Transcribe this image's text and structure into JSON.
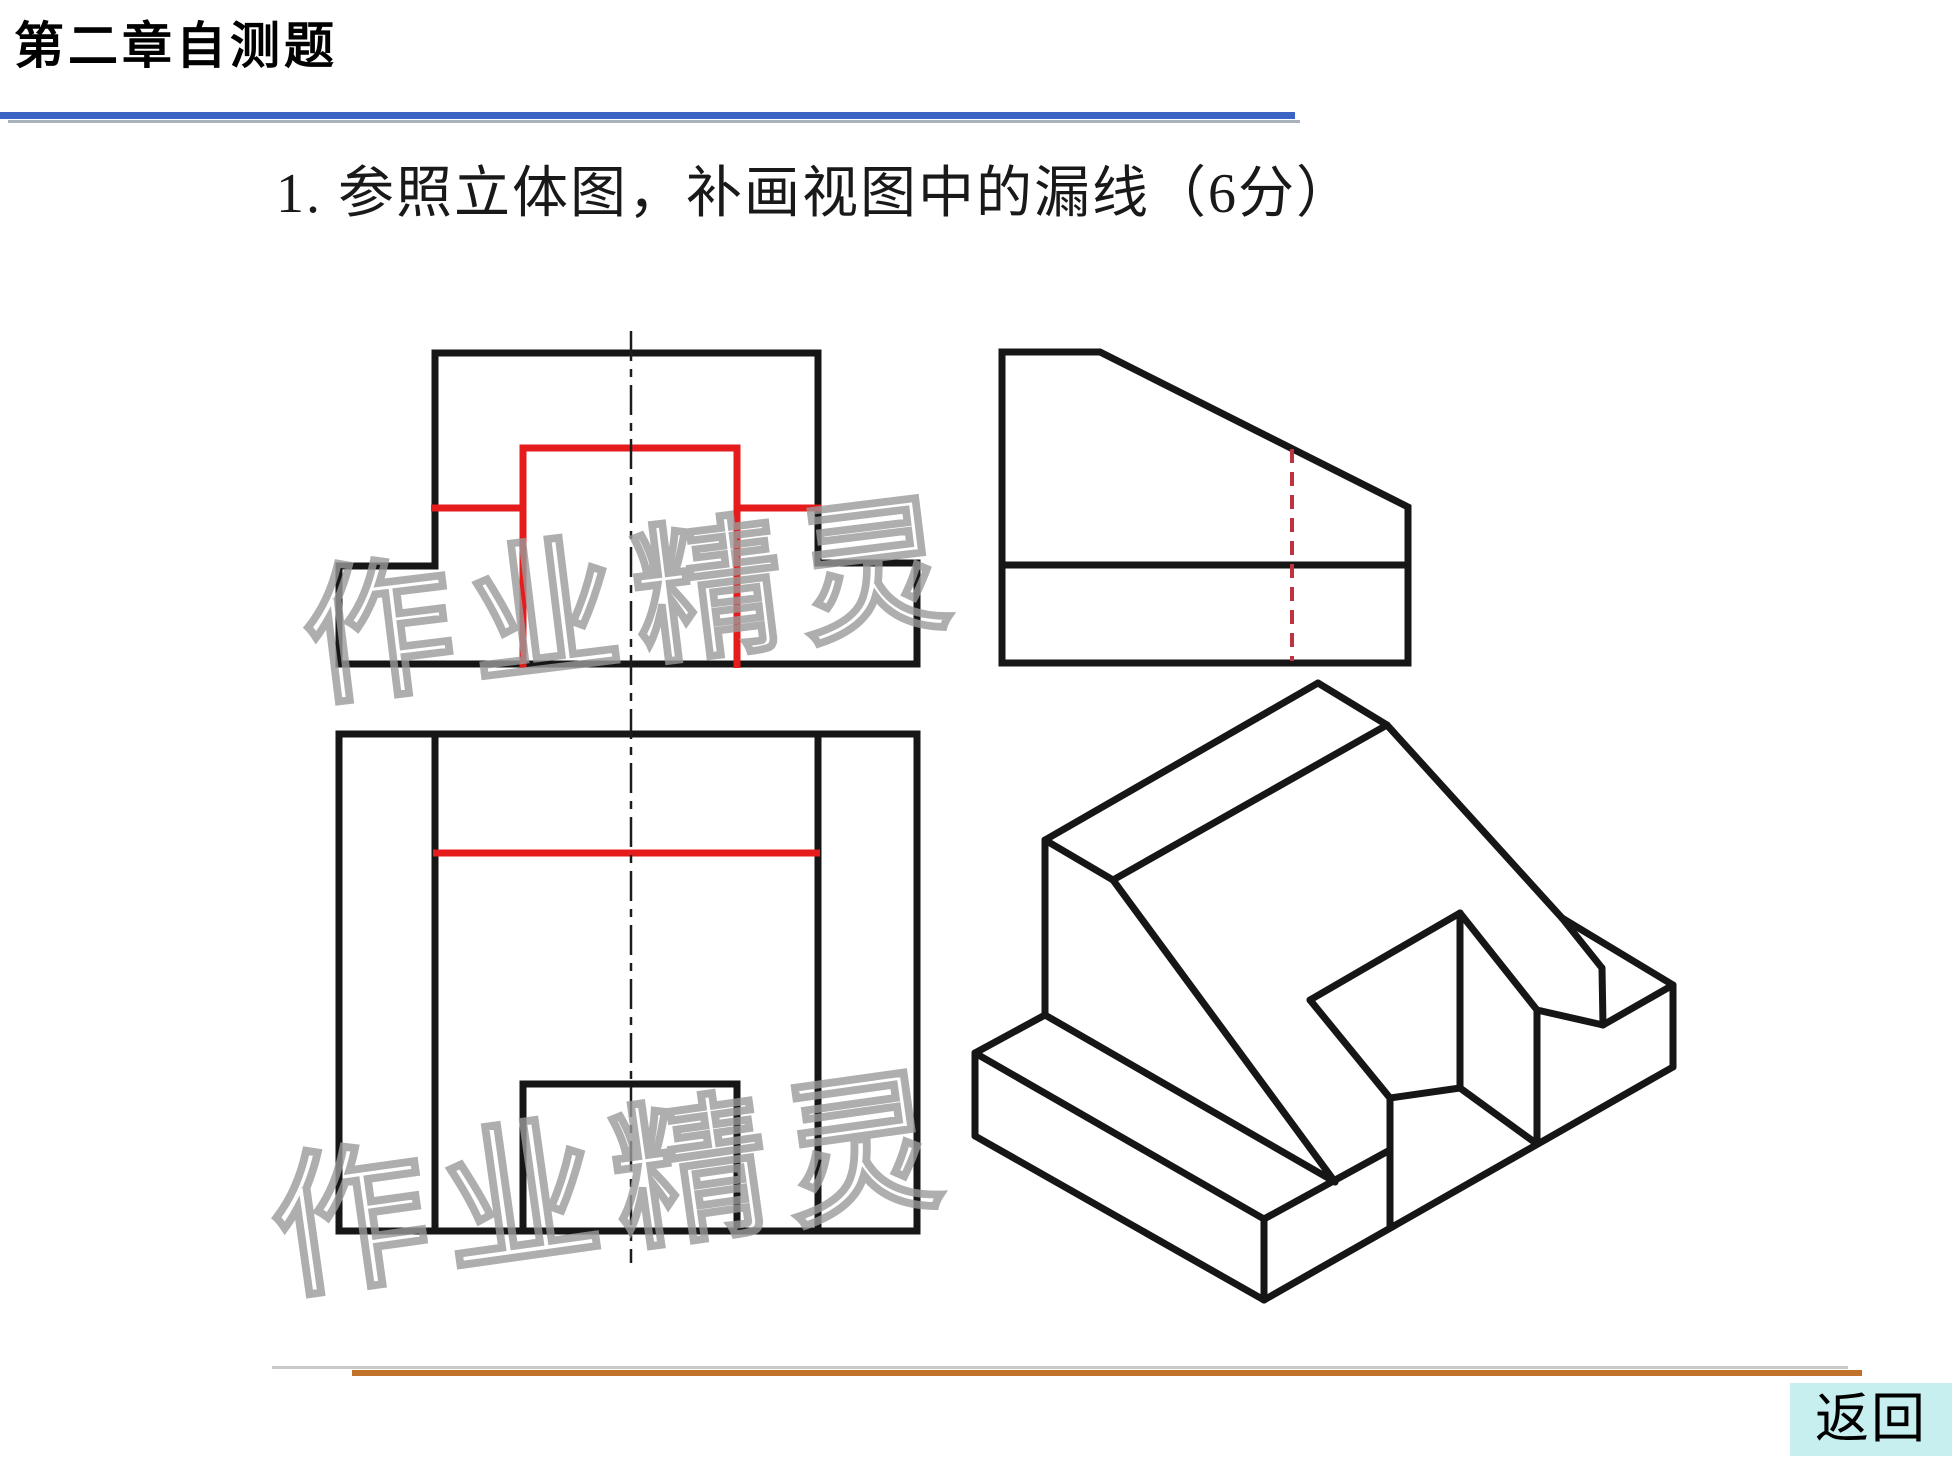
{
  "window": {
    "width": 1955,
    "height": 1462,
    "background": "#ffffff"
  },
  "header": {
    "title": "第二章自测题",
    "title_color": "#000000",
    "rule_blue": "#3a63c4",
    "rule_gray": "#aab2bc"
  },
  "question": {
    "text": "1. 参照立体图，补画视图中的漏线（6分）",
    "color": "#191919"
  },
  "watermark": {
    "text": "作业精灵",
    "stroke": "#9b9b9b",
    "instances": [
      {
        "x": 300,
        "y": 662,
        "size": 150,
        "rotate": -7,
        "cx": 560,
        "cy": 590
      },
      {
        "x": 266,
        "y": 1248,
        "size": 156,
        "rotate": -8,
        "cx": 545,
        "cy": 1165
      }
    ]
  },
  "footer": {
    "rule_orange": "#c1722a",
    "rule_gray": "#c9c9c9",
    "back_label": "返回",
    "back_bg": "#c8efef",
    "back_color": "#000000"
  },
  "drawing": {
    "ink": "#161616",
    "red": "#e61b1b",
    "hidden_red": "#bf3340",
    "centerline_color": "#1c1c1c",
    "views": {
      "front_view": {
        "black": [
          "M435,353 L818,353 L818,563 L917,563 L917,664 L339,664 L339,566 L435,566 Z"
        ],
        "red": [
          "M523,668 L523,448 L737,448 L737,668",
          "M431,508 L523,508",
          "M737,508 L821,508"
        ]
      },
      "side_view": {
        "black": [
          "M1002,352 L1100,352 L1408,507 L1408,663 L1002,663 Z",
          "M1002,565 L1408,565"
        ],
        "red_dashed": [
          "M1292,449 L1292,661"
        ]
      },
      "top_view": {
        "black": [
          "M339,734 L917,734 L917,1231 L339,1231 Z",
          "M435,734 L435,1231",
          "M818,734 L818,1231",
          "M523,1231 L523,1084 L737,1084 L737,1231"
        ],
        "red": [
          "M433,853 L820,853"
        ]
      },
      "isometric_view": {
        "segments": [
          [
            1318,
            683,
            1387,
            725
          ],
          [
            1318,
            683,
            1045,
            840
          ],
          [
            1387,
            725,
            1113,
            880
          ],
          [
            1045,
            840,
            1113,
            880
          ],
          [
            1045,
            840,
            1045,
            1015
          ],
          [
            1113,
            880,
            1335,
            1182
          ],
          [
            1045,
            1015,
            1335,
            1182
          ],
          [
            1045,
            1015,
            975,
            1053
          ],
          [
            975,
            1053,
            975,
            1136
          ],
          [
            975,
            1053,
            1264,
            1219
          ],
          [
            975,
            1136,
            1264,
            1300
          ],
          [
            1264,
            1300,
            1264,
            1219
          ],
          [
            1264,
            1219,
            1390,
            1150
          ],
          [
            1387,
            725,
            1562,
            918
          ],
          [
            1460,
            913,
            1310,
            1000
          ],
          [
            1460,
            913,
            1460,
            1088
          ],
          [
            1460,
            913,
            1537,
            1010
          ],
          [
            1310,
            1000,
            1390,
            1098
          ],
          [
            1390,
            1098,
            1460,
            1088
          ],
          [
            1390,
            1098,
            1390,
            1228
          ],
          [
            1460,
            1088,
            1537,
            1144
          ],
          [
            1537,
            1010,
            1537,
            1144
          ],
          [
            1537,
            1010,
            1603,
            1025
          ],
          [
            1562,
            918,
            1602,
            968
          ],
          [
            1602,
            968,
            1603,
            1025
          ],
          [
            1603,
            1025,
            1673,
            985
          ],
          [
            1562,
            918,
            1673,
            985
          ],
          [
            1673,
            985,
            1673,
            1067
          ],
          [
            1264,
            1300,
            1673,
            1067
          ]
        ]
      }
    },
    "centerlines": [
      {
        "x": 631,
        "y1": 331,
        "y2": 1263
      }
    ]
  }
}
